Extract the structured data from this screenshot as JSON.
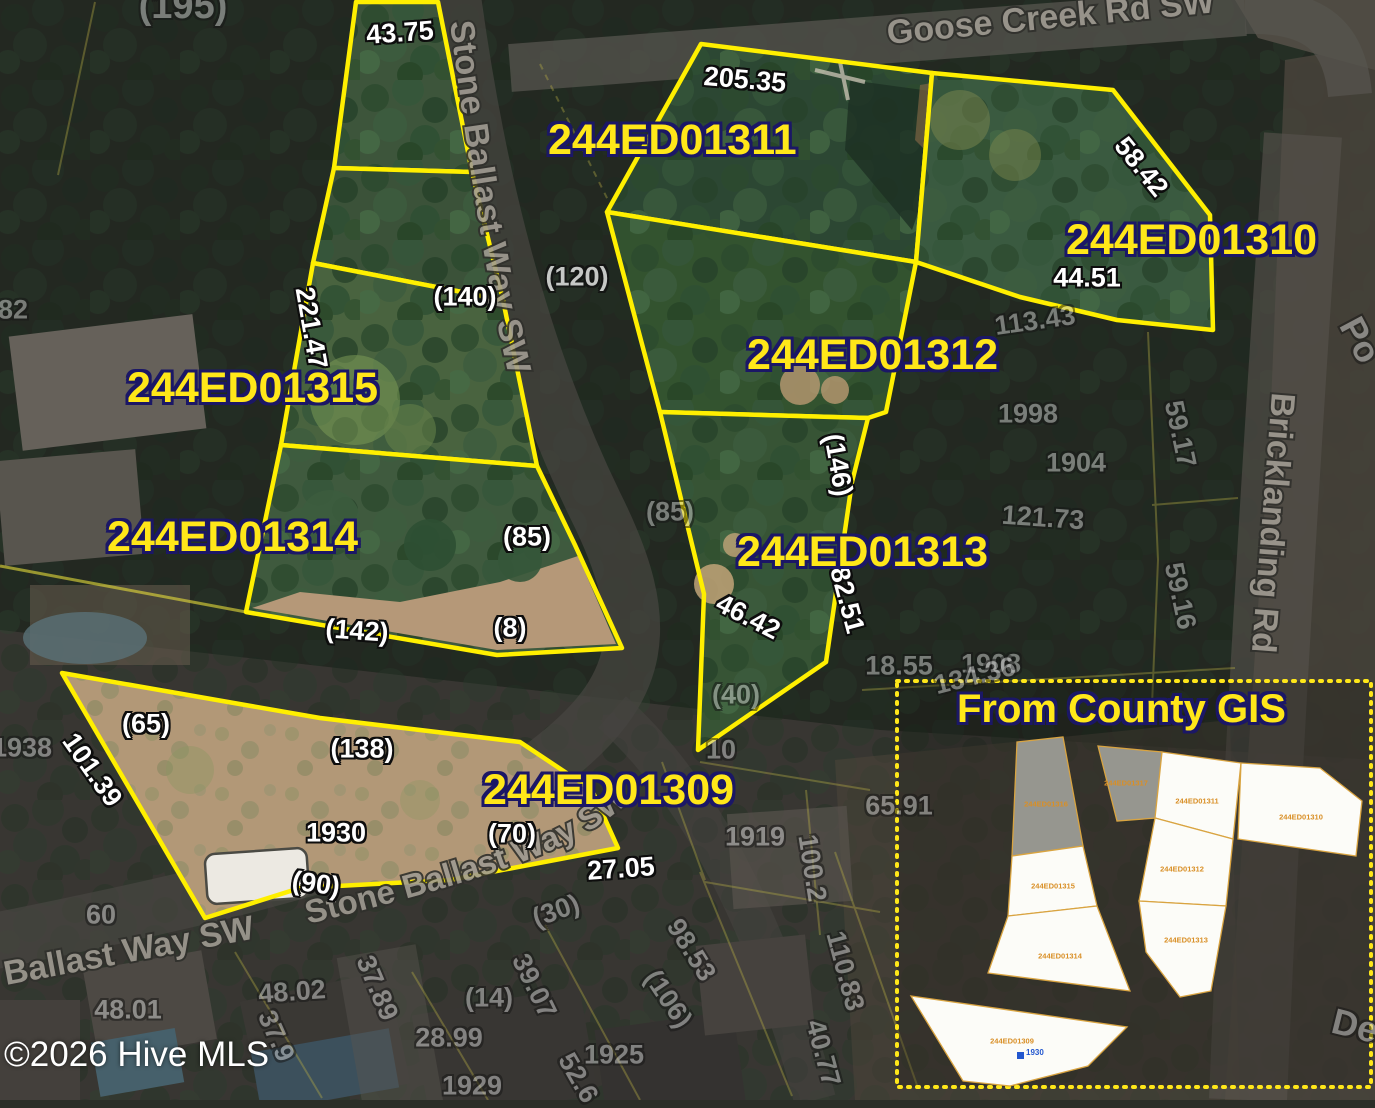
{
  "watermark": "©2026 Hive MLS",
  "roads": {
    "goose_creek": "Goose Creek Rd SW",
    "stone_ballast_top": "Stone Ballast Way SW",
    "stone_ballast_curve": "Stone Ballast Way SW",
    "ballast_bottom_left": "Ballast Way SW",
    "bricklanding": "Bricklanding Rd"
  },
  "parcel_labels": [
    {
      "id": "244ED01311",
      "x": 548,
      "y": 119
    },
    {
      "id": "244ED01310",
      "x": 1066,
      "y": 219
    },
    {
      "id": "244ED01315",
      "x": 127,
      "y": 367
    },
    {
      "id": "244ED01312",
      "x": 747,
      "y": 334
    },
    {
      "id": "244ED01314",
      "x": 107,
      "y": 516
    },
    {
      "id": "244ED01313",
      "x": 737,
      "y": 531
    },
    {
      "id": "244ED01309",
      "x": 483,
      "y": 769
    }
  ],
  "dimension_labels": [
    {
      "t": "(195)",
      "x": 183,
      "y": 6,
      "r": 0,
      "s": "dim",
      "fs": 38
    },
    {
      "t": "43.75",
      "x": 400,
      "y": 33,
      "r": -4,
      "s": "bright"
    },
    {
      "t": "205.35",
      "x": 745,
      "y": 80,
      "r": 5,
      "s": "bright"
    },
    {
      "t": "58.42",
      "x": 1141,
      "y": 167,
      "r": 51,
      "s": "bright"
    },
    {
      "t": "44.51",
      "x": 1087,
      "y": 278,
      "r": 0,
      "s": "bright"
    },
    {
      "t": "221.47",
      "x": 311,
      "y": 328,
      "r": 80,
      "s": "bright"
    },
    {
      "t": "(140)",
      "x": 465,
      "y": 297,
      "r": 0,
      "s": "bright"
    },
    {
      "t": "(120)",
      "x": 577,
      "y": 277,
      "r": 0,
      "s": "mid"
    },
    {
      "t": "113.43",
      "x": 1035,
      "y": 321,
      "r": -8,
      "s": "dim"
    },
    {
      "t": "1998",
      "x": 1028,
      "y": 414,
      "r": 0,
      "s": "dim"
    },
    {
      "t": "1904",
      "x": 1076,
      "y": 463,
      "r": 0,
      "s": "dim"
    },
    {
      "t": "(146)",
      "x": 838,
      "y": 465,
      "r": 80,
      "s": "bright"
    },
    {
      "t": "(85)",
      "x": 670,
      "y": 512,
      "r": 0,
      "s": "dim"
    },
    {
      "t": "(85)",
      "x": 527,
      "y": 537,
      "r": 0,
      "s": "bright"
    },
    {
      "t": "121.73",
      "x": 1043,
      "y": 518,
      "r": 4,
      "s": "dim"
    },
    {
      "t": "59.17",
      "x": 1180,
      "y": 434,
      "r": 78,
      "s": "dim"
    },
    {
      "t": "59.16",
      "x": 1180,
      "y": 596,
      "r": 78,
      "s": "dim"
    },
    {
      "t": "82.51",
      "x": 847,
      "y": 600,
      "r": 75,
      "s": "bright"
    },
    {
      "t": "46.42",
      "x": 748,
      "y": 617,
      "r": 27,
      "s": "bright"
    },
    {
      "t": "(142)",
      "x": 357,
      "y": 631,
      "r": 4,
      "s": "bright"
    },
    {
      "t": "(8)",
      "x": 510,
      "y": 628,
      "r": 0,
      "s": "bright"
    },
    {
      "t": "18.55",
      "x": 899,
      "y": 666,
      "r": 0,
      "s": "dim"
    },
    {
      "t": "1908",
      "x": 991,
      "y": 664,
      "r": 0,
      "s": "dim"
    },
    {
      "t": "134.36",
      "x": 975,
      "y": 676,
      "r": -14,
      "s": "dim"
    },
    {
      "t": "(40)",
      "x": 736,
      "y": 695,
      "r": 0,
      "s": "dim"
    },
    {
      "t": "(65)",
      "x": 146,
      "y": 724,
      "r": 0,
      "s": "bright"
    },
    {
      "t": "101.39",
      "x": 92,
      "y": 770,
      "r": 55,
      "s": "bright"
    },
    {
      "t": "(138)",
      "x": 362,
      "y": 749,
      "r": 0,
      "s": "bright"
    },
    {
      "t": "10",
      "x": 721,
      "y": 750,
      "r": 0,
      "s": "dim"
    },
    {
      "t": "1938",
      "x": 22,
      "y": 748,
      "r": 0,
      "s": "dim"
    },
    {
      "t": "82",
      "x": 13,
      "y": 310,
      "r": 0,
      "s": "dim"
    },
    {
      "t": "65.91",
      "x": 899,
      "y": 806,
      "r": 0,
      "s": "dim"
    },
    {
      "t": "1919",
      "x": 755,
      "y": 837,
      "r": 0,
      "s": "dim"
    },
    {
      "t": "100.2",
      "x": 812,
      "y": 868,
      "r": 81,
      "s": "dim"
    },
    {
      "t": "1930",
      "x": 336,
      "y": 833,
      "r": 0,
      "s": "bright"
    },
    {
      "t": "(90)",
      "x": 316,
      "y": 884,
      "r": 8,
      "s": "bright"
    },
    {
      "t": "(70)",
      "x": 512,
      "y": 834,
      "r": 0,
      "s": "bright"
    },
    {
      "t": "27.05",
      "x": 621,
      "y": 869,
      "r": -4,
      "s": "bright"
    },
    {
      "t": "60",
      "x": 101,
      "y": 915,
      "r": 0,
      "s": "dim"
    },
    {
      "t": "(30)",
      "x": 556,
      "y": 911,
      "r": -20,
      "s": "dim"
    },
    {
      "t": "98.53",
      "x": 691,
      "y": 950,
      "r": 58,
      "s": "dim"
    },
    {
      "t": "(106)",
      "x": 668,
      "y": 999,
      "r": 56,
      "s": "dim"
    },
    {
      "t": "48.01",
      "x": 128,
      "y": 1010,
      "r": 0,
      "s": "dim"
    },
    {
      "t": "48.02",
      "x": 292,
      "y": 992,
      "r": -4,
      "s": "dim"
    },
    {
      "t": "37.89",
      "x": 377,
      "y": 988,
      "r": 67,
      "s": "dim"
    },
    {
      "t": "37.9",
      "x": 276,
      "y": 1036,
      "r": 66,
      "s": "dim"
    },
    {
      "t": "39.07",
      "x": 534,
      "y": 986,
      "r": 64,
      "s": "dim"
    },
    {
      "t": "(14)",
      "x": 489,
      "y": 998,
      "r": 0,
      "s": "dim"
    },
    {
      "t": "28.99",
      "x": 449,
      "y": 1038,
      "r": 0,
      "s": "dim"
    },
    {
      "t": "1925",
      "x": 614,
      "y": 1055,
      "r": 0,
      "s": "dim"
    },
    {
      "t": "52.6",
      "x": 578,
      "y": 1078,
      "r": 60,
      "s": "dim"
    },
    {
      "t": "1929",
      "x": 472,
      "y": 1086,
      "r": 0,
      "s": "dim"
    },
    {
      "t": "110.83",
      "x": 845,
      "y": 971,
      "r": 75,
      "s": "dim"
    },
    {
      "t": "40.77",
      "x": 823,
      "y": 1053,
      "r": 75,
      "s": "dim"
    },
    {
      "t": "Po",
      "x": 1360,
      "y": 340,
      "r": 62,
      "s": "dim",
      "fs": 36
    },
    {
      "t": "De",
      "x": 1355,
      "y": 1026,
      "r": 14,
      "s": "dim",
      "fs": 36
    }
  ],
  "inset": {
    "title": "From County GIS",
    "marker_label": "1930",
    "parcel_labels": [
      {
        "id": "244ED01316",
        "x": 1046,
        "y": 804
      },
      {
        "id": "244ED01315",
        "x": 1053,
        "y": 886
      },
      {
        "id": "244ED01314",
        "x": 1060,
        "y": 956
      },
      {
        "id": "244ED01309",
        "x": 1012,
        "y": 1041
      },
      {
        "id": "244ED01317",
        "x": 1126,
        "y": 783
      },
      {
        "id": "244ED01311",
        "x": 1197,
        "y": 801
      },
      {
        "id": "244ED01312",
        "x": 1182,
        "y": 869
      },
      {
        "id": "244ED01313",
        "x": 1186,
        "y": 940
      },
      {
        "id": "244ED01310",
        "x": 1301,
        "y": 817
      }
    ]
  },
  "colors": {
    "parcel_outline": "#ffef00",
    "parcel_label": "#ffe719",
    "label_outline": "#1b1766",
    "inset_border": "#ffe719",
    "inset_parcel_outline": "#d9a441",
    "inset_label": "#d98f26",
    "marker_blue": "#2257cf"
  }
}
